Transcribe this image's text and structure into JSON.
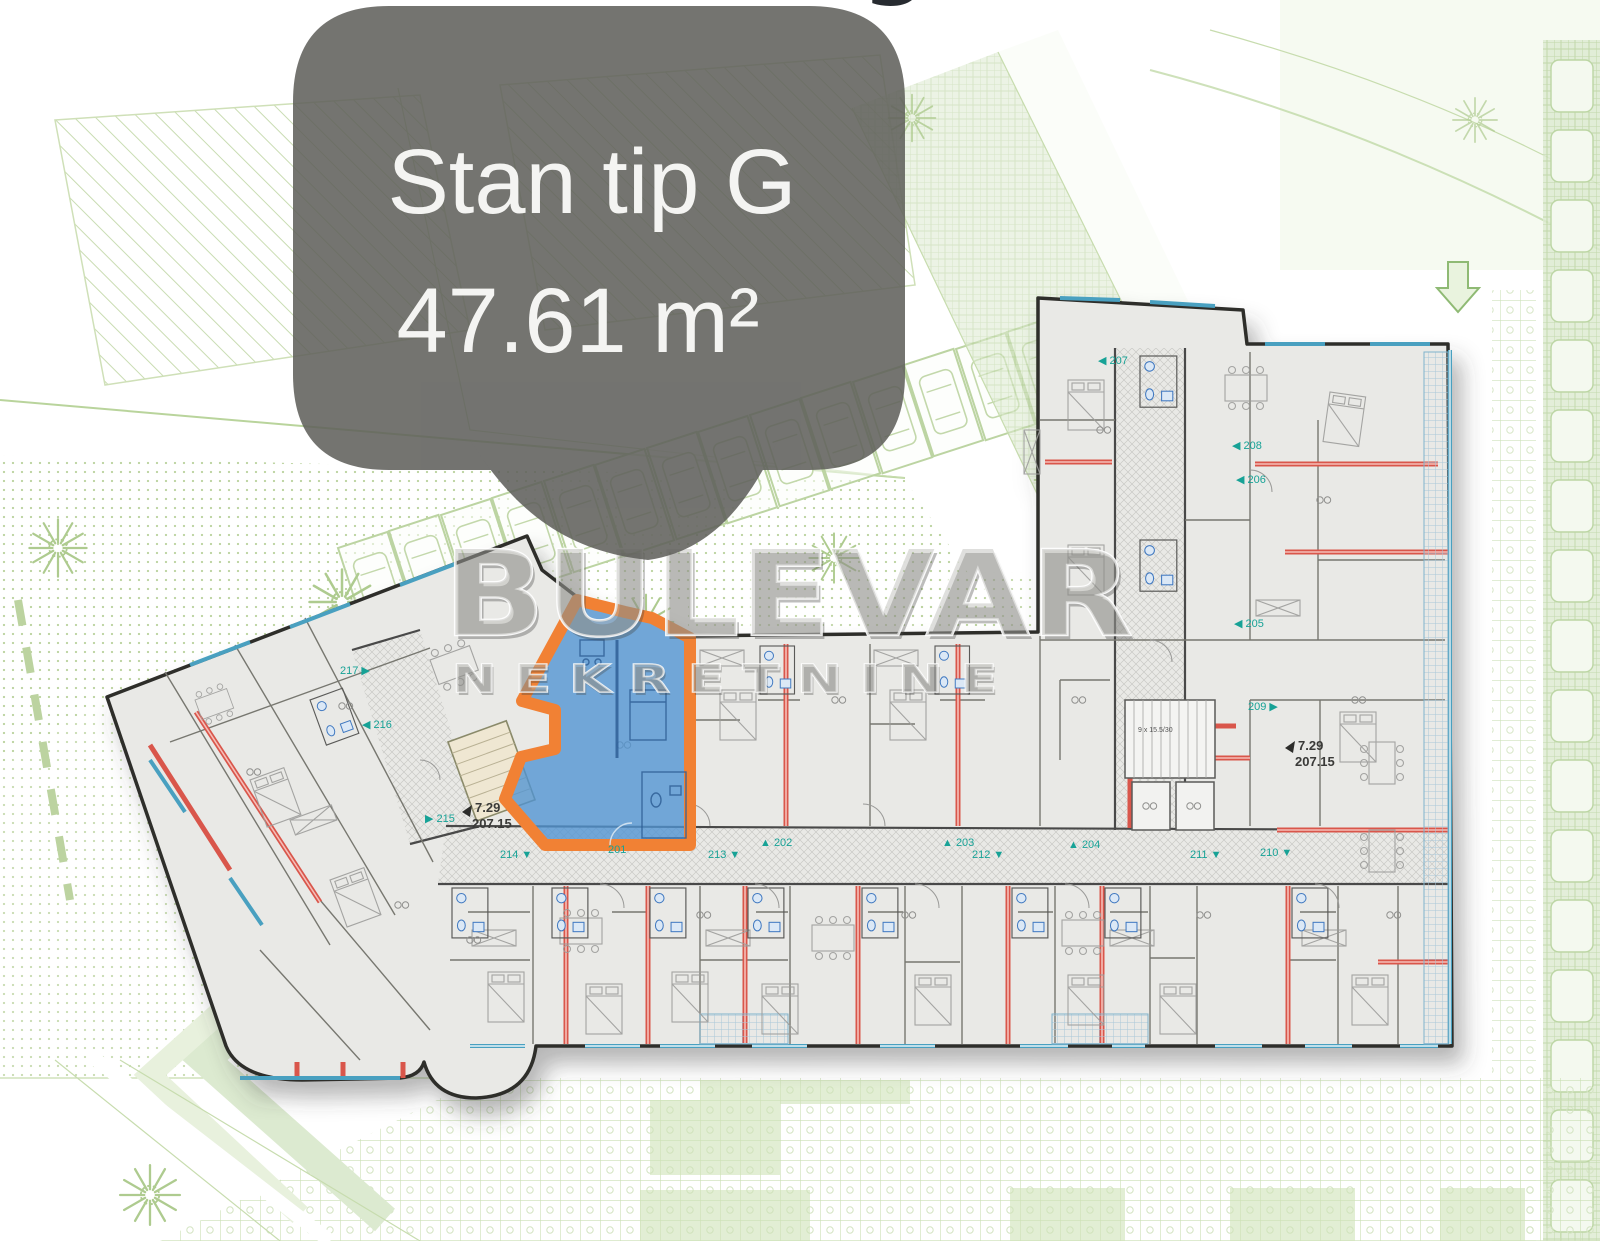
{
  "callout": {
    "title": "Stan tip G",
    "area": "47.61 m²",
    "bubble_color": "#5f5f5b",
    "text_color": "#f4f4f2"
  },
  "heading_fragment": {
    "text": "g"
  },
  "watermark": {
    "primary": "BULEVAR",
    "secondary": "NEKRETNINE",
    "secondary_spaced": "N E K R E T N I N E"
  },
  "level_markers": {
    "left": {
      "height": "7.29",
      "elevation": "207.15"
    },
    "right": {
      "height": "7.29",
      "elevation": "207.15"
    }
  },
  "stair_note": "9 x 15.5/30",
  "unit_labels": [
    {
      "text": "217",
      "marker": "▶",
      "pos": "after",
      "x": 340,
      "y": 674
    },
    {
      "text": "216",
      "marker": "◀",
      "pos": "before",
      "x": 362,
      "y": 728
    },
    {
      "text": "215",
      "marker": "▶",
      "pos": "before",
      "x": 425,
      "y": 822
    },
    {
      "text": "214",
      "marker": "▼",
      "pos": "after",
      "x": 500,
      "y": 858
    },
    {
      "text": "201",
      "marker": "",
      "pos": "after",
      "x": 608,
      "y": 853
    },
    {
      "text": "213",
      "marker": "▼",
      "pos": "after",
      "x": 708,
      "y": 858
    },
    {
      "text": "202",
      "marker": "▲",
      "pos": "before",
      "x": 760,
      "y": 846
    },
    {
      "text": "203",
      "marker": "▲",
      "pos": "before",
      "x": 942,
      "y": 846
    },
    {
      "text": "212",
      "marker": "▼",
      "pos": "after",
      "x": 972,
      "y": 858
    },
    {
      "text": "204",
      "marker": "▲",
      "pos": "before",
      "x": 1068,
      "y": 848
    },
    {
      "text": "211",
      "marker": "▼",
      "pos": "after",
      "x": 1190,
      "y": 858
    },
    {
      "text": "210",
      "marker": "▼",
      "pos": "after",
      "x": 1260,
      "y": 856
    },
    {
      "text": "209",
      "marker": "▶",
      "pos": "after",
      "x": 1248,
      "y": 710
    },
    {
      "text": "205",
      "marker": "◀",
      "pos": "before",
      "x": 1234,
      "y": 627
    },
    {
      "text": "206",
      "marker": "◀",
      "pos": "before",
      "x": 1236,
      "y": 483
    },
    {
      "text": "208",
      "marker": "◀",
      "pos": "before",
      "x": 1232,
      "y": 449
    },
    {
      "text": "207",
      "marker": "◀",
      "pos": "before",
      "x": 1098,
      "y": 364
    }
  ],
  "colors": {
    "highlight_fill": "#4f93d2",
    "highlight_outline": "#f18134",
    "wall_red": "#d9574b",
    "window_teal": "#4aa0c0",
    "annotation_teal": "#17a296",
    "site_green": "#b9d49c"
  }
}
